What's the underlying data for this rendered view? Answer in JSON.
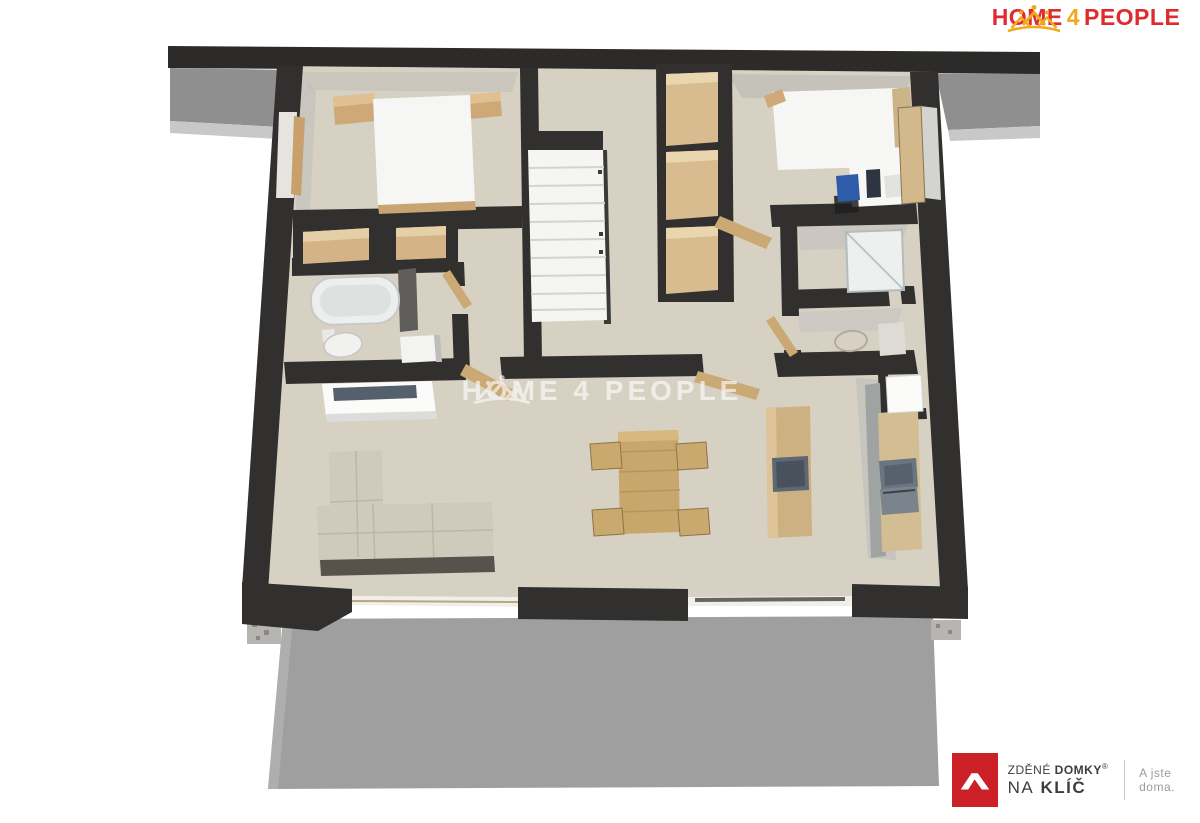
{
  "brand": {
    "home": "HOME",
    "four": "4",
    "people": "PEOPLE"
  },
  "watermark": {
    "home": "HOME",
    "four": "4",
    "people": "PEOPLE"
  },
  "footer_logo": {
    "line1_regular": "ZDĚNÉ",
    "line1_bold": "DOMKY",
    "registered": "®",
    "line2_regular": "NA",
    "line2_bold": "KLÍČ",
    "tagline": "A jste doma."
  },
  "icons": {
    "crown": "crown-people-icon",
    "roof": "house-roof-icon"
  },
  "colors": {
    "brand_red": "#e02a30",
    "brand_yellow": "#f2a81d",
    "logo_red": "#cb2026",
    "text_dark": "#3d3d3c",
    "tagline_gray": "#9b9b9b",
    "divider_gray": "#cccccc",
    "watermark_white": "#ffffff",
    "wall_dark": "#31302e",
    "floor_beige": "#d7d1c4",
    "terrace_gray": "#9f9f9f",
    "wood_tan": "#cfa878"
  }
}
